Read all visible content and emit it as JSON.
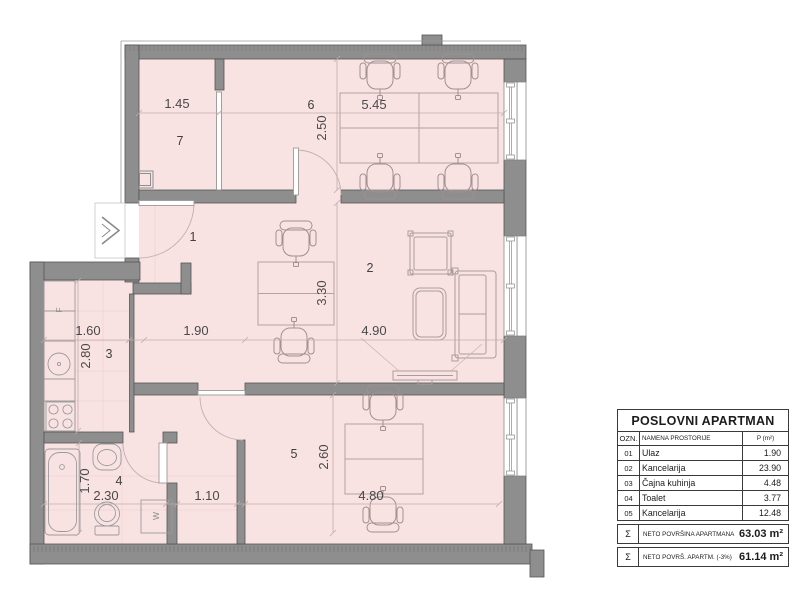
{
  "plan": {
    "rooms": {
      "r1": "1",
      "r2": "2",
      "r3": "3",
      "r4": "4",
      "r5": "5",
      "r6": "6",
      "r7": "7"
    },
    "dims": {
      "d145": "1.45",
      "d545": "5.45",
      "d250": "2.50",
      "d160": "1.60",
      "d190": "1.90",
      "d490": "4.90",
      "d280": "2.80",
      "d330": "3.30",
      "d170": "1.70",
      "d230": "2.30",
      "d110": "1.10",
      "d260": "2.60",
      "d480": "4.80"
    },
    "fixtures": {
      "fridge": "F",
      "washer": "W"
    }
  },
  "legend": {
    "title": "POSLOVNI APARTMAN",
    "header": {
      "ozn": "OZN.",
      "name": "NAMENA PROSTORIJE",
      "area": "P (m²)"
    },
    "rows": [
      {
        "ozn": "01",
        "name": "Ulaz",
        "area": "1.90"
      },
      {
        "ozn": "02",
        "name": "Kancelarija",
        "area": "23.90"
      },
      {
        "ozn": "03",
        "name": "Čajna kuhinja",
        "area": "4.48"
      },
      {
        "ozn": "04",
        "name": "Toalet",
        "area": "3.77"
      },
      {
        "ozn": "05",
        "name": "Kancelarija",
        "area": "12.48"
      }
    ],
    "totals": [
      {
        "sym": "Σ",
        "label": "NETO POVRŠINA APARTMANA",
        "value": "63.03 m²"
      },
      {
        "sym": "Σ",
        "label": "NETO POVRŠ. APARTM. (-3%)",
        "value": "61.14 m²"
      }
    ]
  },
  "colors": {
    "room_fill": "#f9e2e2",
    "wall": "#8e8e8e",
    "wall_stroke": "#555555",
    "furniture": "#ab9c9c",
    "dimension_text": "#4a4a4a"
  }
}
